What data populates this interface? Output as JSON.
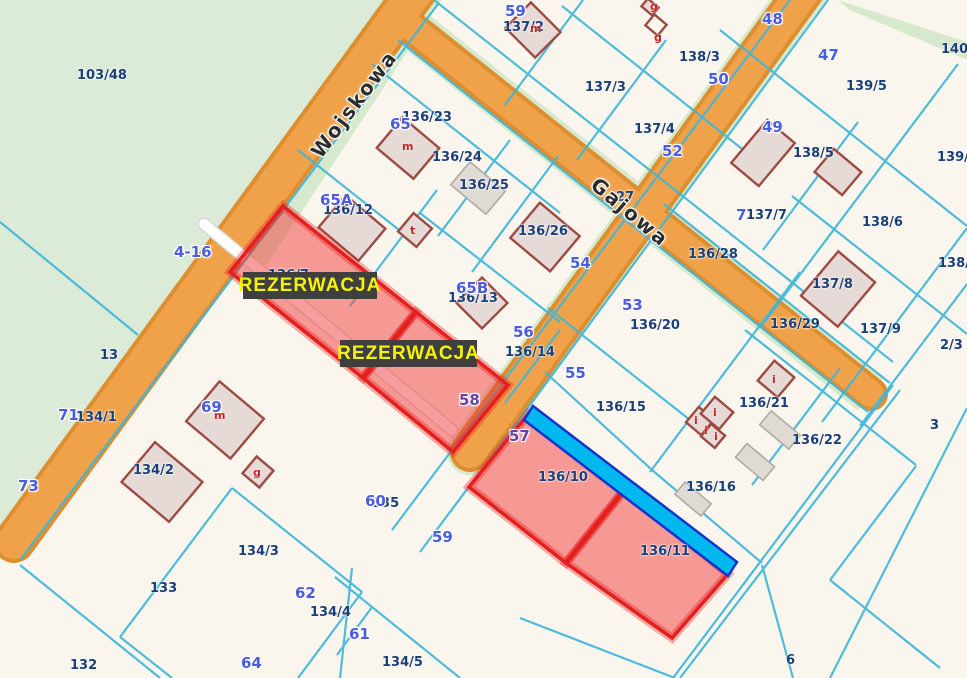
{
  "map": {
    "title": "cadastral-parcel-map",
    "colors": {
      "background": "#faf6ed",
      "green_area": "#dcebd8",
      "road_verge": "#d6e9cc",
      "road_fill": "#f0a24b",
      "road_casing": "#dd8f2f",
      "parcel_line": "#3fb6d8",
      "parcel_label": "#1c3f77",
      "house_number": "#4a5ce0",
      "building_fill": "#e5dad6",
      "building_stroke": "#9e4a44",
      "reservation_fill": "rgba(242,60,60,0.5)",
      "reservation_stroke": "#e41f1f",
      "ditch_fill": "#00b8f0",
      "ditch_stroke": "#1533cc",
      "badge_bg": "#3f3f3f",
      "badge_text": "#f4f400"
    },
    "street_names": [
      {
        "text": "Wojskowa",
        "x": 354,
        "y": 104,
        "rot": -53
      },
      {
        "text": "Gajowa",
        "x": 630,
        "y": 212,
        "rot": 40
      }
    ],
    "reservation_badges": [
      {
        "text": "REZERWACJA",
        "x": 243,
        "y": 272,
        "w": 134,
        "h": 27
      },
      {
        "text": "REZERWACJA",
        "x": 340,
        "y": 340,
        "w": 137,
        "h": 27
      }
    ],
    "parcel_labels": [
      {
        "text": "103/48",
        "x": 77,
        "y": 68
      },
      {
        "text": "137/2",
        "x": 503,
        "y": 20
      },
      {
        "text": "137/3",
        "x": 585,
        "y": 80
      },
      {
        "text": "138/3",
        "x": 679,
        "y": 50
      },
      {
        "text": "137/4",
        "x": 634,
        "y": 122
      },
      {
        "text": "138/5",
        "x": 793,
        "y": 146
      },
      {
        "text": "139/5",
        "x": 846,
        "y": 79
      },
      {
        "text": "140",
        "x": 941,
        "y": 42
      },
      {
        "text": "139/",
        "x": 937,
        "y": 150
      },
      {
        "text": "138/",
        "x": 938,
        "y": 256
      },
      {
        "text": "136/23",
        "x": 402,
        "y": 110
      },
      {
        "text": "136/24",
        "x": 432,
        "y": 150
      },
      {
        "text": "136/25",
        "x": 459,
        "y": 178
      },
      {
        "text": "136/12",
        "x": 323,
        "y": 203
      },
      {
        "text": "136/26",
        "x": 518,
        "y": 224
      },
      {
        "text": "137/7",
        "x": 746,
        "y": 208
      },
      {
        "text": "136/28",
        "x": 688,
        "y": 247
      },
      {
        "text": "138/6",
        "x": 862,
        "y": 215
      },
      {
        "text": "137/8",
        "x": 812,
        "y": 277
      },
      {
        "text": "136/29",
        "x": 770,
        "y": 317
      },
      {
        "text": "137/9",
        "x": 860,
        "y": 322
      },
      {
        "text": "2/3",
        "x": 940,
        "y": 338
      },
      {
        "text": "136/7",
        "x": 268,
        "y": 268
      },
      {
        "text": "136/13",
        "x": 448,
        "y": 291
      },
      {
        "text": "136/14",
        "x": 505,
        "y": 345
      },
      {
        "text": "136/20",
        "x": 630,
        "y": 318
      },
      {
        "text": "136/15",
        "x": 596,
        "y": 400
      },
      {
        "text": "136/21",
        "x": 739,
        "y": 396
      },
      {
        "text": "136/22",
        "x": 792,
        "y": 433
      },
      {
        "text": "136/16",
        "x": 686,
        "y": 480
      },
      {
        "text": "136/10",
        "x": 538,
        "y": 470
      },
      {
        "text": "136/11",
        "x": 640,
        "y": 544
      },
      {
        "text": "27",
        "x": 616,
        "y": 190
      },
      {
        "text": "13",
        "x": 100,
        "y": 348
      },
      {
        "text": "134/1",
        "x": 76,
        "y": 410
      },
      {
        "text": "134/2",
        "x": 133,
        "y": 463
      },
      {
        "text": "135",
        "x": 372,
        "y": 496
      },
      {
        "text": "134/3",
        "x": 238,
        "y": 544
      },
      {
        "text": "133",
        "x": 150,
        "y": 581
      },
      {
        "text": "132",
        "x": 70,
        "y": 658
      },
      {
        "text": "134/4",
        "x": 310,
        "y": 605
      },
      {
        "text": "134/5",
        "x": 382,
        "y": 655
      },
      {
        "text": "6",
        "x": 786,
        "y": 653
      },
      {
        "text": "3",
        "x": 930,
        "y": 418
      }
    ],
    "house_numbers": [
      {
        "text": "59",
        "x": 505,
        "y": 2,
        "variant": "blue"
      },
      {
        "text": "65",
        "x": 390,
        "y": 115,
        "variant": "blue"
      },
      {
        "text": "65A",
        "x": 320,
        "y": 191,
        "variant": "blue"
      },
      {
        "text": "65B",
        "x": 456,
        "y": 279,
        "variant": "blue"
      },
      {
        "text": "4-16",
        "x": 174,
        "y": 243,
        "variant": "blue"
      },
      {
        "text": "48",
        "x": 762,
        "y": 10,
        "variant": "blue"
      },
      {
        "text": "47",
        "x": 818,
        "y": 46,
        "variant": "blue"
      },
      {
        "text": "50",
        "x": 708,
        "y": 70,
        "variant": "blue"
      },
      {
        "text": "49",
        "x": 762,
        "y": 118,
        "variant": "blue"
      },
      {
        "text": "52",
        "x": 662,
        "y": 142,
        "variant": "blue"
      },
      {
        "text": "7",
        "x": 736,
        "y": 206,
        "variant": "blue"
      },
      {
        "text": "54",
        "x": 570,
        "y": 254,
        "variant": "blue"
      },
      {
        "text": "53",
        "x": 622,
        "y": 296,
        "variant": "blue"
      },
      {
        "text": "56",
        "x": 513,
        "y": 323,
        "variant": "blue"
      },
      {
        "text": "55",
        "x": 565,
        "y": 364,
        "variant": "blue"
      },
      {
        "text": "57",
        "x": 509,
        "y": 427,
        "variant": "purple"
      },
      {
        "text": "58",
        "x": 459,
        "y": 391,
        "variant": "purple"
      },
      {
        "text": "71",
        "x": 58,
        "y": 406,
        "variant": "blue"
      },
      {
        "text": "73",
        "x": 18,
        "y": 477,
        "variant": "blue"
      },
      {
        "text": "69",
        "x": 201,
        "y": 398,
        "variant": "blue"
      },
      {
        "text": "60",
        "x": 365,
        "y": 492,
        "variant": "blue"
      },
      {
        "text": "59",
        "x": 432,
        "y": 528,
        "variant": "blue"
      },
      {
        "text": "62",
        "x": 295,
        "y": 584,
        "variant": "blue"
      },
      {
        "text": "61",
        "x": 349,
        "y": 625,
        "variant": "blue"
      },
      {
        "text": "64",
        "x": 241,
        "y": 654,
        "variant": "blue"
      }
    ],
    "building_letters": [
      {
        "text": "m",
        "x": 530,
        "y": 22
      },
      {
        "text": "g",
        "x": 650,
        "y": 0
      },
      {
        "text": "g",
        "x": 654,
        "y": 31
      },
      {
        "text": "m",
        "x": 402,
        "y": 140
      },
      {
        "text": "t",
        "x": 410,
        "y": 224
      },
      {
        "text": "m",
        "x": 214,
        "y": 409
      },
      {
        "text": "g",
        "x": 253,
        "y": 466
      },
      {
        "text": "i",
        "x": 694,
        "y": 414
      },
      {
        "text": "i",
        "x": 713,
        "y": 406
      },
      {
        "text": "i",
        "x": 704,
        "y": 424
      },
      {
        "text": "i",
        "x": 714,
        "y": 430
      },
      {
        "text": "i",
        "x": 772,
        "y": 373
      }
    ]
  }
}
